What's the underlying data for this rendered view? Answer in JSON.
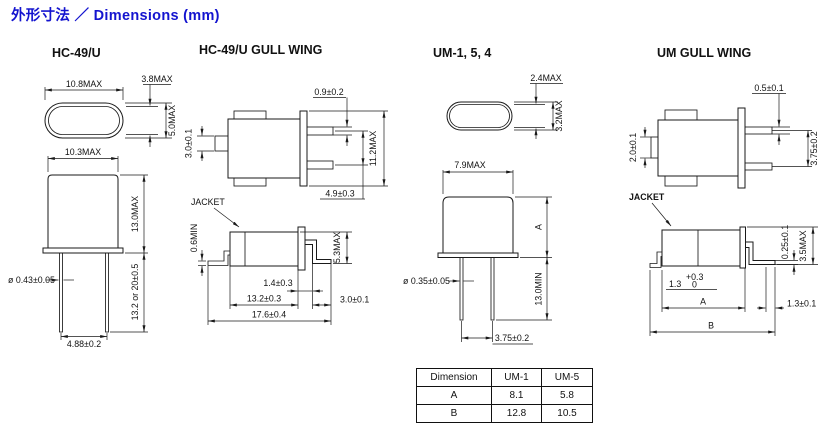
{
  "title": "外形寸法 ／ Dimensions (mm)",
  "panels": {
    "hc49u": {
      "heading": "HC-49/U",
      "dims": {
        "top_width": "10.8MAX",
        "lead_gap": "3.8MAX",
        "oval_height": "5.0MAX",
        "body_width": "10.3MAX",
        "body_height": "13.0MAX",
        "lead_dia": "ø 0.43±0.05",
        "lead_length": "13.2  or  20±0.5",
        "lead_spacing": "4.88±0.2"
      }
    },
    "hc49u_gullwing": {
      "heading": "HC-49/U GULL WING",
      "dims": {
        "lead_width": "0.9±0.2",
        "overall_height": "11.2MAX",
        "lead_pitch": "4.9±0.3",
        "tab_height": "3.0±0.1",
        "jacket_label": "JACKET",
        "jacket_margin": "0.6MIN",
        "body_dia": "5.3MAX",
        "flange_width": "1.4±0.3",
        "body_length": "13.2±0.3",
        "lead_foot": "3.0±0.1",
        "overall_length": "17.6±0.4"
      }
    },
    "um": {
      "heading": "UM-1, 5, 4",
      "dims": {
        "oval_inner_height": "2.4MAX",
        "oval_height": "3.2MAX",
        "body_width": "7.9MAX",
        "body_height": "A",
        "lead_dia": "ø 0.35±0.05",
        "lead_length": "13.0MIN",
        "lead_spacing": "3.75±0.2"
      }
    },
    "um_gullwing": {
      "heading": "UM GULL WING",
      "dims": {
        "lead_width": "0.5±0.1",
        "tab_height": "2.0±0.1",
        "lead_pitch": "3.75±0.2",
        "jacket_label": "JACKET",
        "lead_thickness": "0.25±0.1",
        "body_dia": "3.5MAX",
        "flange_value": "1.3",
        "flange_tol_plus": "+0.3",
        "flange_tol_minus": "0",
        "body_length": "A",
        "overall_length": "B",
        "foot_length": "1.3±0.1"
      }
    }
  },
  "table": {
    "headers": [
      "Dimension",
      "UM-1",
      "UM-5"
    ],
    "rows": [
      {
        "dimension": "A",
        "um1": "8.1",
        "um5": "5.8"
      },
      {
        "dimension": "B",
        "um1": "12.8",
        "um5": "10.5"
      }
    ]
  },
  "colors": {
    "title_blue": "#1414cf",
    "line": "#1a1a1a"
  }
}
